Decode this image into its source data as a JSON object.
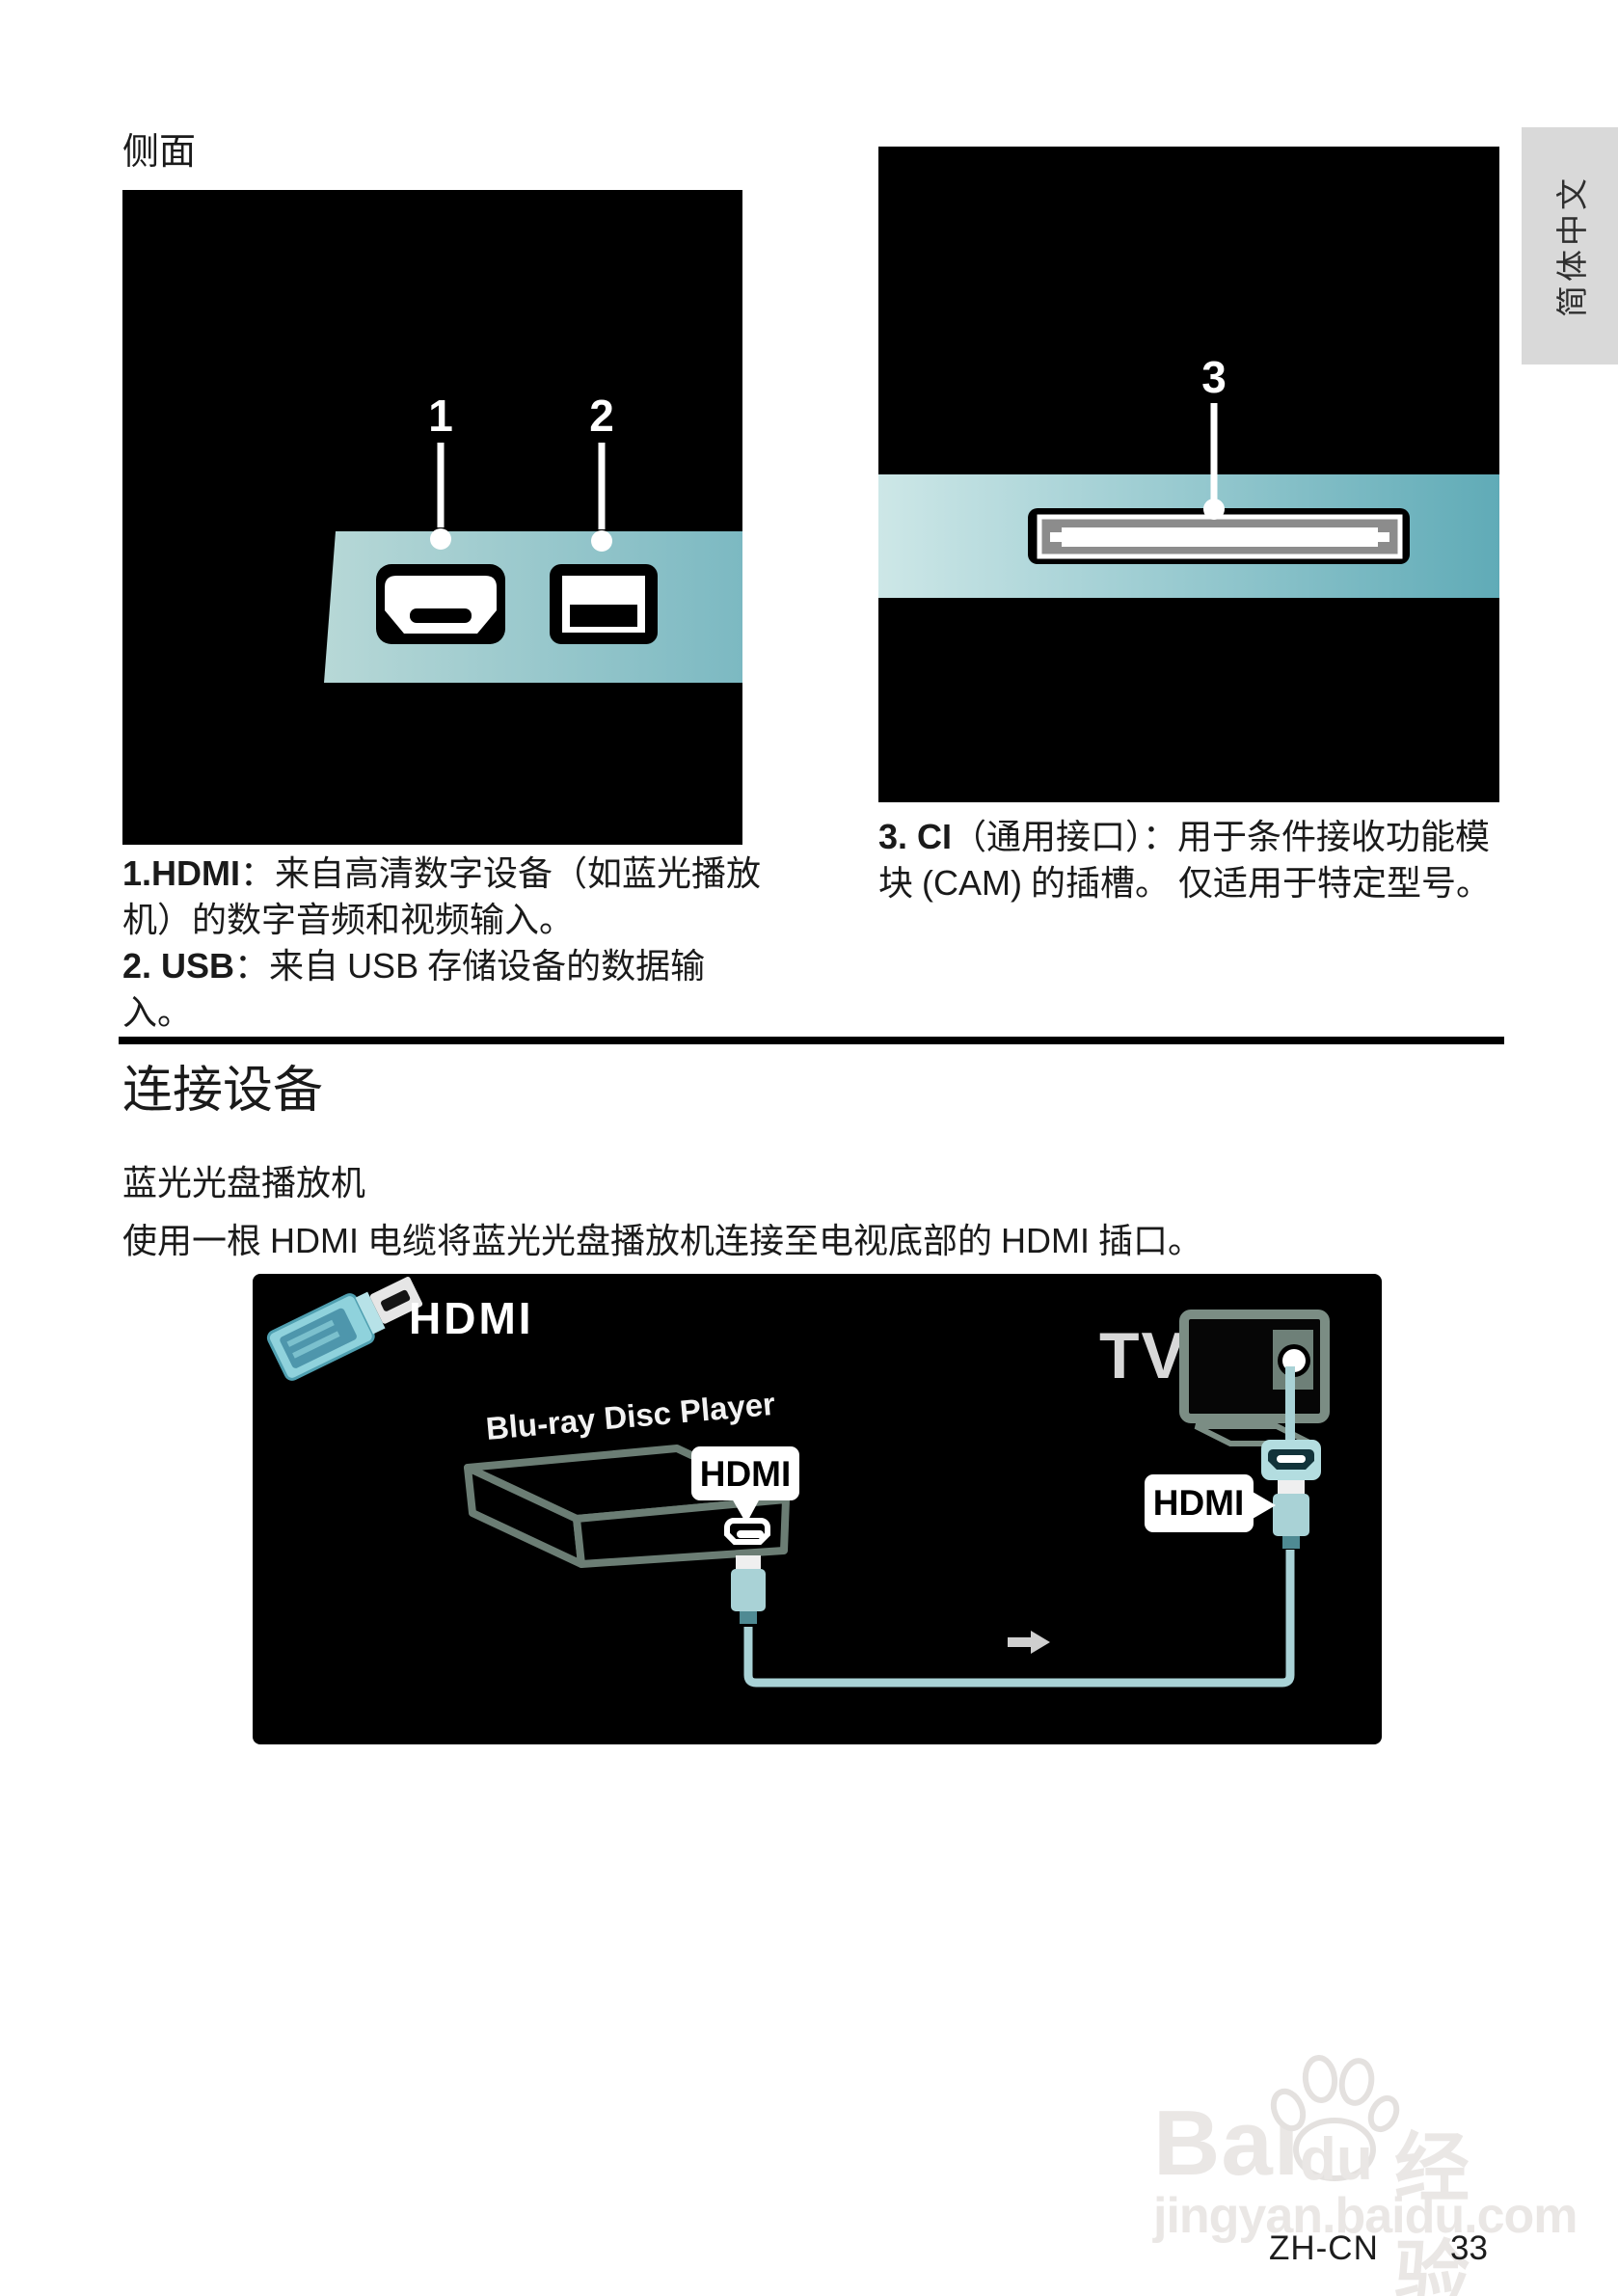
{
  "side": {
    "section_label": "侧面",
    "port1": "1",
    "port2": "2",
    "port3": "3",
    "desc_left": {
      "l1_bold": "1.HDMI",
      "l1_rest": "：来自高清数字设备（如蓝光播放",
      "l2": "机）的数字音频和视频输入。",
      "l3_bold": "2. USB",
      "l3_mid": "：来自 ",
      "l3_latin": "USB",
      "l3_rest": " 存储设备的数据输入。"
    },
    "desc_right": {
      "l1_bold": "3. CI",
      "l1_rest": "（通用接口）：用于条件接收功能模",
      "l2_a": "块 ",
      "l2_latin": "(CAM)",
      "l2_b": " 的插槽。 仅适用于特定型号。"
    }
  },
  "language_tab": {
    "label": "简体中文"
  },
  "connect": {
    "title": "连接设备",
    "subtitle": "蓝光光盘播放机",
    "instr_1": "使用一根 ",
    "instr_2": "HDMI",
    "instr_3": " 电缆将蓝光光盘播放机连接至电视底部的 ",
    "instr_4": "HDMI",
    "instr_5": " 插口。"
  },
  "diagram": {
    "hdmi_title": "HDMI",
    "device_label": "Blu-ray Disc Player",
    "tv_label": "TV",
    "bubble_player": "HDMI",
    "bubble_tv": "HDMI"
  },
  "watermark": {
    "bai": "Bai",
    "du": "du",
    "suffix": "经验",
    "url": "jingyan.baidu.com"
  },
  "footer": {
    "language_code": "ZH-CN",
    "page_number": "33"
  },
  "colors": {
    "band_left_light": "#b7d8d7",
    "band_left_dark": "#7cb9c2",
    "band_right_light": "#cde7e7",
    "band_right_dark": "#60abb7",
    "cable_teal": "#a9d2d6",
    "plug_blue": "#8fd2dc",
    "outline_green": "#6b7d74",
    "ci_gray": "#8c8c8c",
    "tab_bg": "#d9d9d9",
    "watermark_gray": "#eae7e5"
  }
}
